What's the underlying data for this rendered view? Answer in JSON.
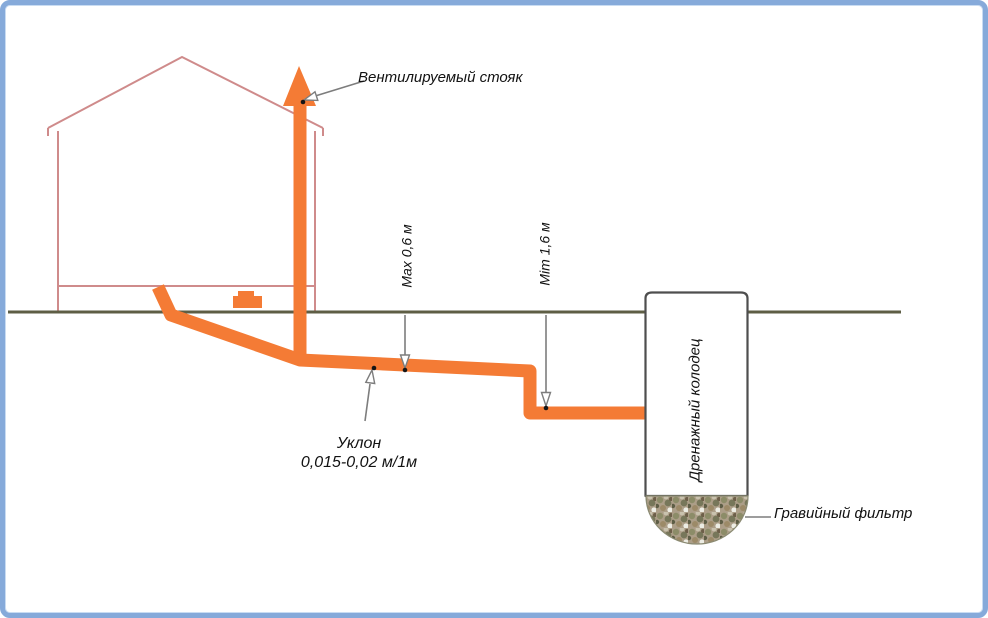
{
  "diagram_title": "Схема наружной канализации частного дома с дренажным колодцем",
  "labels": {
    "vent_stack": "Вентилируемый стояк",
    "max_depth": "Max 0,6 м",
    "min_depth": "Mim 1,6 м",
    "slope_line1": "Уклон",
    "slope_line2": "0,015-0,02 м/1м",
    "drainage_well": "Дренажный колодец",
    "gravel_filter": "Гравийный фильтр"
  },
  "colors": {
    "frame-blue": "#86AADA",
    "frame-blue-inner": "#C9DCF2",
    "pipe-orange": "#F47B35",
    "house-outline": "#CF8B8B",
    "ground-line": "#5E5E45",
    "well-border": "#4E4E4E",
    "arrow-gray": "#7D7D7D",
    "gravel-base": "#AC9E88",
    "text": "#121212"
  }
}
